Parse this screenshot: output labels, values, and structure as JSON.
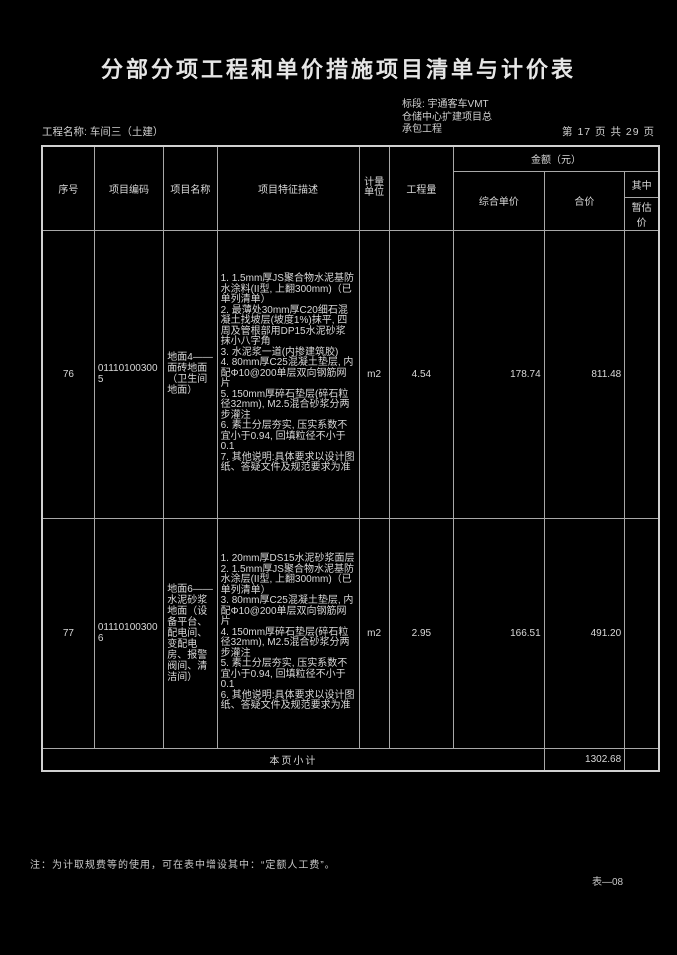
{
  "page": {
    "title": "分部分项工程和单价措施项目清单与计价表",
    "project_label": "工程名称: 车间三（土建）",
    "section_label": "标段: 宇通客车VMT\n仓储中心扩建项目总\n承包工程",
    "page_info": "第 17 页  共 29 页",
    "note": "注：为计取规费等的使用，可在表中增设其中：“定额人工费”。",
    "form_code": "表—08"
  },
  "table": {
    "headers": {
      "seq": "序号",
      "code": "项目编码",
      "name": "项目名称",
      "features": "项目特征描述",
      "unit": "计量\n单位",
      "quantity": "工程量",
      "amount_group": "金额（元）",
      "unit_price": "综合单价",
      "total_price": "合价",
      "among": "其中",
      "provisional": "暂估价"
    },
    "rows": [
      {
        "seq": "76",
        "code": "011101003005",
        "name": "地面4——面砖地面（卫生间地面）",
        "features": "1. 1.5mm厚JS聚合物水泥基防水涂料(II型, 上翻300mm)（已单列清单）\n2. 最薄处30mm厚C20细石混凝土找坡层(坡度1%)抹平, 四周及管根部用DP15水泥砂浆抹小八字角\n3. 水泥浆一道(内掺建筑胶)\n4. 80mm厚C25混凝土垫层, 内配Φ10@200单层双向钢筋网片\n5. 150mm厚碎石垫层(碎石粒径32mm), M2.5混合砂浆分两步灌注\n6. 素土分层夯实, 压实系数不宜小于0.94, 回填粒径不小于0.1\n7. 其他说明:具体要求以设计图纸、答疑文件及规范要求为准",
        "unit": "m2",
        "quantity": "4.54",
        "unit_price": "178.74",
        "total_price": "811.48",
        "provisional": ""
      },
      {
        "seq": "77",
        "code": "011101003006",
        "name": "地面6——水泥砂浆地面（设备平台、配电间、变配电房、报警阀间、清洁间）",
        "features": "1. 20mm厚DS15水泥砂浆面层\n2. 1.5mm厚JS聚合物水泥基防水涂层(II型, 上翻300mm)（已单列清单）\n3. 80mm厚C25混凝土垫层, 内配Φ10@200单层双向钢筋网片\n4. 150mm厚碎石垫层(碎石粒径32mm), M2.5混合砂浆分两步灌注\n5. 素土分层夯实, 压实系数不宜小于0.94, 回填粒径不小于0.1\n6. 其他说明:具体要求以设计图纸、答疑文件及规范要求为准",
        "unit": "m2",
        "quantity": "2.95",
        "unit_price": "166.51",
        "total_price": "491.20",
        "provisional": ""
      }
    ],
    "subtotal": {
      "label": "本页小计",
      "total_price": "1302.68",
      "provisional": ""
    }
  }
}
